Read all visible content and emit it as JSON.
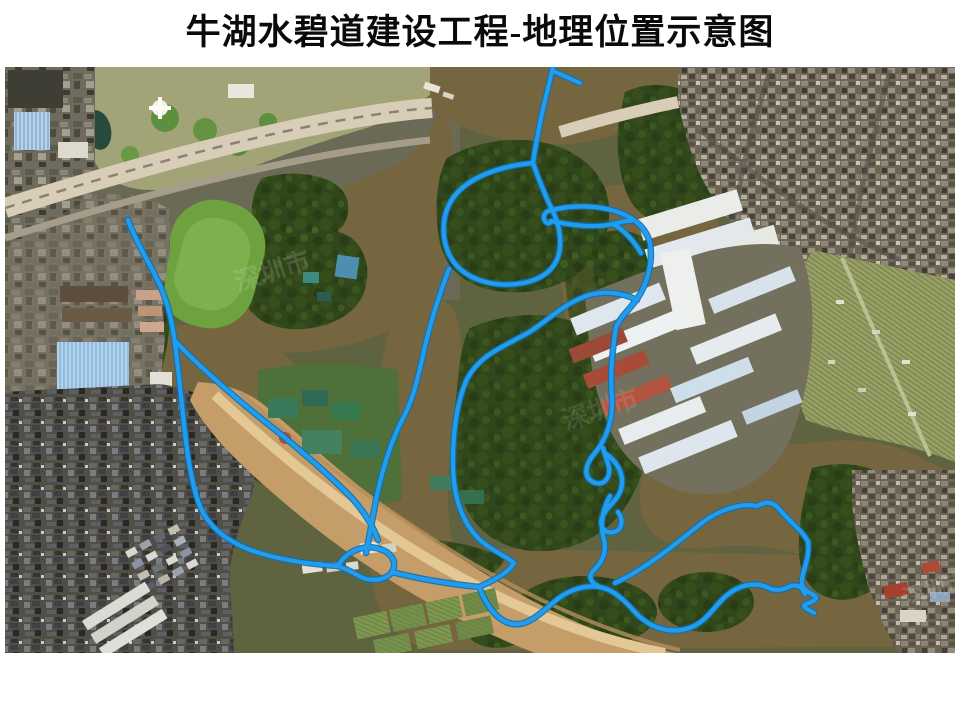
{
  "title": "牛湖水碧道建设工程-地理位置示意图",
  "map": {
    "name": "satellite-location-map",
    "description": "aerial-imagery-with-greenway-route-overlay",
    "watermark": "深圳市",
    "route_color": "#229ded",
    "route_casing_color": "#0f6fb2",
    "palette": {
      "water_brown": "#75663f",
      "forest_green": "#30471b",
      "lawn_green": "#6da23e",
      "road_tan": "#d8cdb6",
      "construction_tan": "#c59d69",
      "farmland_olive": "#9aa166",
      "urban_dark": "#504e46",
      "urban_mid": "#6e675a",
      "warehouse_white": "#e9ece8",
      "warehouse_blue": "#cfdfe9",
      "roof_red": "#a84b38",
      "factory_blue": "#8fbcdf"
    }
  }
}
